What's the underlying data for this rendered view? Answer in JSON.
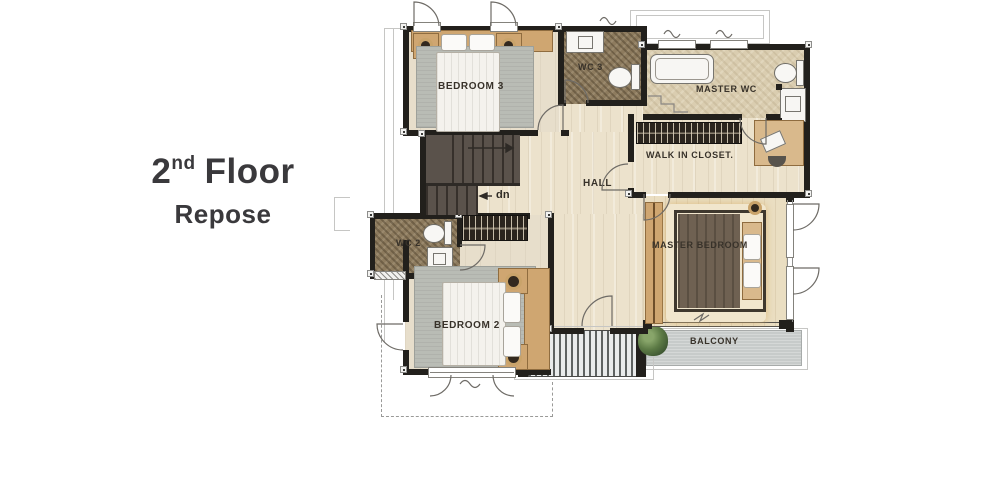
{
  "title": {
    "floor_number": "2",
    "ordinal_suffix": "nd",
    "floor_word": "Floor",
    "subtitle": "Repose"
  },
  "rooms": {
    "bedroom3": {
      "label": "BEDROOM 3"
    },
    "wc3": {
      "label": "WC 3"
    },
    "master_wc": {
      "label": "MASTER WC"
    },
    "walk_in_closet": {
      "label": "WALK IN CLOSET."
    },
    "hall": {
      "label": "HALL"
    },
    "master_bedroom": {
      "label": "MASTER BEDROOM"
    },
    "wc2": {
      "label": "WC 2"
    },
    "bedroom2": {
      "label": "BEDROOM 2"
    },
    "balcony": {
      "label": "BALCONY"
    }
  },
  "stairs": {
    "direction_label": "dn"
  },
  "palette": {
    "wall": "#22201c",
    "wood_floor": "#ece2cc",
    "tile_brown": "#8d7b5e",
    "tile_beige": "#dacdb0",
    "rug_gray": "#b9bcb5",
    "wood_tan": "#cfa671",
    "stair_brown": "#5a524b",
    "balcony_gray": "#c7cbca",
    "plant_green": "#5c7a45",
    "title_text": "#3a393c",
    "label_text": "#38322a"
  }
}
